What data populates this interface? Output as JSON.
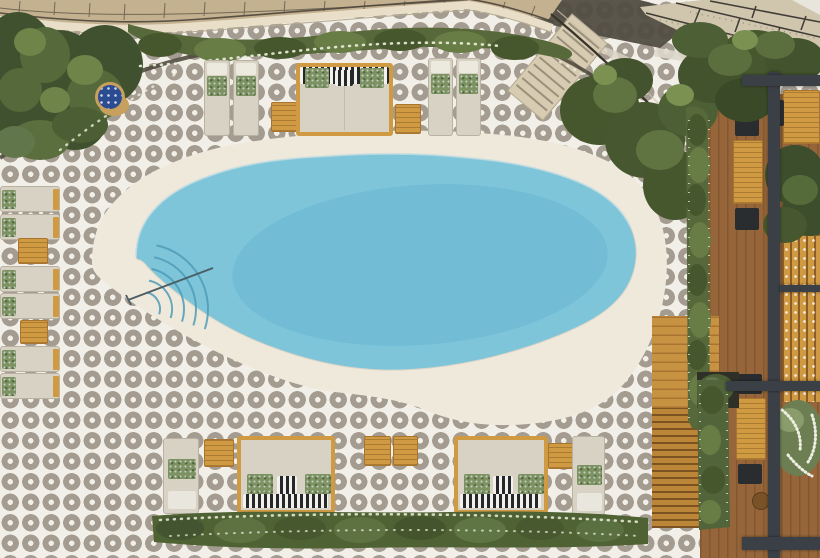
{
  "scene": {
    "title": "Aerial view of a hotel pool deck with free-form swimming pool",
    "labels": {
      "scene": "Overhead photo of resort pool terrace",
      "pool": "Free-form light-blue swimming pool with fan-shaped entry steps and handrail",
      "apron": "Cream concrete pool apron",
      "tiles": "Black and white patterned tile deck",
      "building": "Building balcony edge with railing at top",
      "terrazzo": "Terrazzo balcony walkway at top right",
      "stairs": "Staircase descending from building to pool deck",
      "hedge_top": "Planted hedge border along building",
      "hedge_bottom": "Low hedge behind bottom daybeds",
      "deck_right": "Raised wooden dining deck with tables",
      "platform": "Golden wood step platform to deck",
      "pergola": "Dark pergola frame over right deck",
      "loungers": "Beige sun loungers with green botanical pillows",
      "daybeds": "Wood-framed daybeds with striped cushions",
      "blue_table": "Round blue mosaic side table",
      "trees": "Dense green trees in top-left planter"
    }
  },
  "palette": {
    "tile_bg": "#f2efe9",
    "tile_motif": "#a49c90",
    "deck_cream": "#efe9dc",
    "pool_water": "#7ec5da",
    "pool_water_deep": "#66b5cf",
    "pool_rim": "#b9e0eb",
    "steps_line": "#4f9cb8",
    "rail": "#4a5d63",
    "building_tan": "#c3b190",
    "building_line": "#6a604f",
    "band_cream": "#e9dfc9",
    "railing_dark": "#4e463c",
    "shadow_dark": "#514d42",
    "terrazzo": "#d0c5ad",
    "terrazzo_line": "#3f3c35",
    "terrazzo_speck": "#978e7a",
    "stair_beige": "#d7cbb1",
    "stair_line": "#9a907b",
    "stair_rail": "#3a352c",
    "soil": "#4a443a",
    "tree_dark": "#3f512f",
    "tree_mid": "#55693b",
    "tree_light": "#6e8449",
    "hedge_green": "#57693b",
    "hedge_dark": "#46572e",
    "hedge_light": "#687c45",
    "highlight_green": "#7b9152",
    "flower_white": "#ecefdb",
    "bush_white": "#edefe3",
    "wood_deck": "#96663a",
    "wood_deck_line": "#835731",
    "wood_golden": "#cf9a42",
    "wood_golden_dark": "#a87430",
    "platform_wood": "#c89243",
    "stair_wood": "#bb8638",
    "pergola": "#3b4046",
    "chair_black": "#2a2d30",
    "planter_dark": "#2f3129",
    "cushion_beige": "#d8d2c5",
    "cushion_edge": "#b9b2a3",
    "cushion_white": "#eceade",
    "pillow_green": "#7c9263",
    "pillow_green_dark": "#5f7747",
    "stripe_dark": "#25272a",
    "stripe_light": "#f2f1ec",
    "towel_white": "#e9e6dd",
    "table_blue": "#2c4c92",
    "table_blue_dot": "#cfd9ec",
    "wicker_tan": "#c8a05e"
  }
}
